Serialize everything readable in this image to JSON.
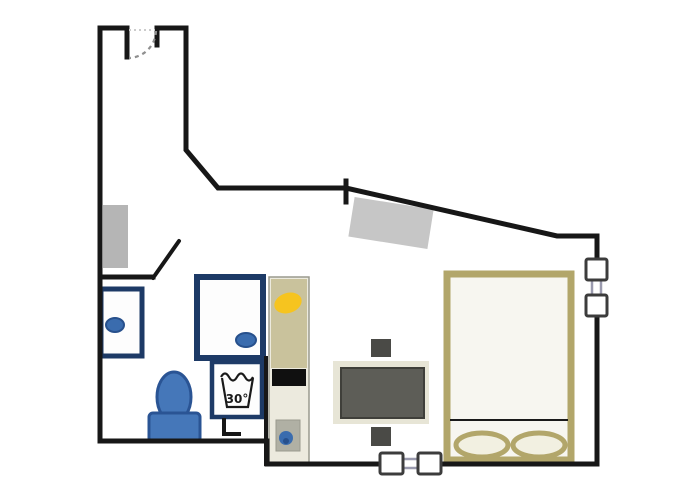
{
  "plan": {
    "type": "studio-apartment-floor-plan",
    "labels": {
      "washing_machine_temp": "30°"
    }
  },
  "colors": {
    "background": "#ffffff",
    "wall": "#171717",
    "door_arc": "#8f8f8f",
    "door_opening": "#cccccc",
    "fixture_border": "#1d3a66",
    "fixture_fill": "#fdfdfd",
    "drain_blue": "#3a6cae",
    "drain_blue_dark": "#27508c",
    "toilet_fill": "#4577b9",
    "toilet_stroke": "#2a5494",
    "radiator_left": "#b5b5b5",
    "radiator_top": "#c6c6c6",
    "counter_body": "#eceade",
    "counter_top": "#c9c29c",
    "counter_border": "#9a9a8e",
    "cooktop": "#101010",
    "sink_basin": "#b0b0a4",
    "accessory_yellow": "#f6c41f",
    "dining_mat": "#e7e5d6",
    "table_fill": "#5d5d57",
    "table_stroke": "#3f3f3a",
    "chair_fill": "#4a4a46",
    "bed_frame": "#b2a66a",
    "bed_fill": "#f7f6f0",
    "pillow_fill": "#f2f0e1",
    "blanket_line": "#1a1a1a",
    "symbol_ink": "#1a1a1a",
    "window_frame": "#3c3c3c",
    "window_fill": "#ffffff",
    "window_pane": "#9a9aae"
  }
}
